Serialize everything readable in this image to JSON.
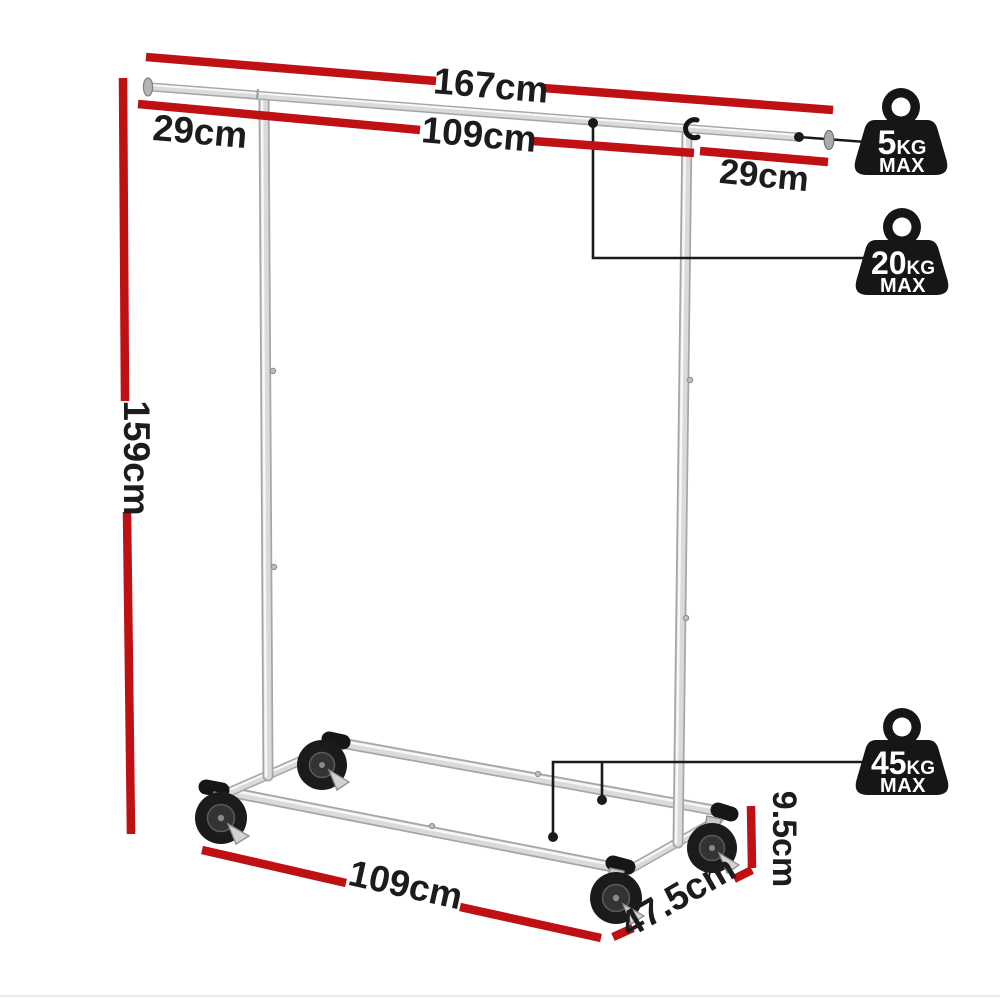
{
  "title": "Clothes rack dimension diagram",
  "dimensions": {
    "total_width": "167cm",
    "top_rail_center": "109cm",
    "left_extension": "29cm",
    "right_extension": "29cm",
    "height": "159cm",
    "base_length": "109cm",
    "base_depth": "47.5cm",
    "caster_height": "9.5cm"
  },
  "badges": [
    {
      "value": "5",
      "unit": "KG",
      "max": "MAX"
    },
    {
      "value": "20",
      "unit": "KG",
      "max": "MAX"
    },
    {
      "value": "45",
      "unit": "KG",
      "max": "MAX"
    }
  ],
  "colors": {
    "dimension_line": "#bf1014",
    "badge_fill": "#161616",
    "label_text": "#1c1c1c"
  }
}
